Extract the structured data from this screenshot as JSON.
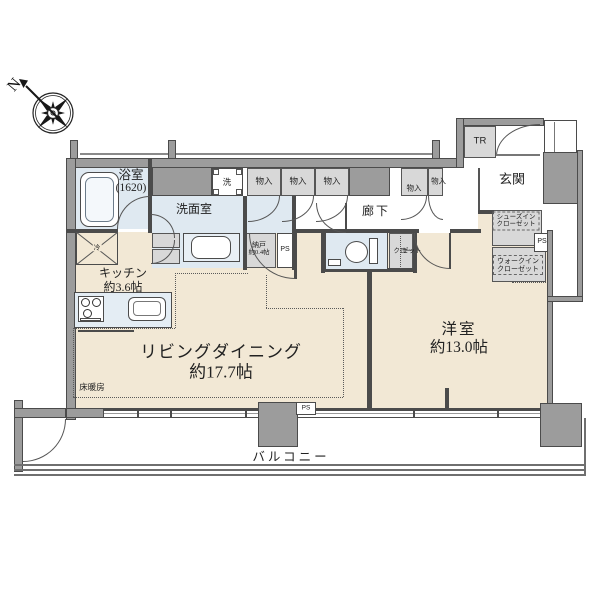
{
  "compass": {
    "north_label": "N"
  },
  "rooms": {
    "bathroom": {
      "name": "浴室",
      "size": "(1620)"
    },
    "washroom": {
      "name": "洗面室"
    },
    "kitchen": {
      "name": "キッチン",
      "size": "約3.6帖"
    },
    "living_dining": {
      "name": "リビングダイニング",
      "size": "約17.7帖"
    },
    "bedroom": {
      "name": "洋室",
      "size": "約13.0帖"
    },
    "hallway": {
      "name": "廊下"
    },
    "entrance": {
      "name": "玄関"
    },
    "balcony": {
      "name": "バルコニー"
    },
    "small_storage": {
      "name": "納戸",
      "size": "約0.4帖"
    },
    "floor_heating_label": "床暖房"
  },
  "storage": {
    "mono_iri_labels": [
      "物入",
      "物入",
      "物入",
      "物入",
      "物入"
    ],
    "closet_vertical": [
      "クロー",
      "ゼット"
    ],
    "shoes_in_closet": [
      "シューズイン",
      "クローゼット"
    ],
    "walk_in_closet": [
      "ウォークイン",
      "クローゼット"
    ],
    "trunk_room": "TR"
  },
  "fixtures": {
    "washer": "洗",
    "fridge": "冷",
    "pipe_space": "PS"
  },
  "colors": {
    "floor_beige": "#f2e8d5",
    "water_blue": "#dfe9f1",
    "closet_gray": "#d8d8d8",
    "wall_gray": "#9c9c9c",
    "line_dark": "#4b4b4b"
  }
}
